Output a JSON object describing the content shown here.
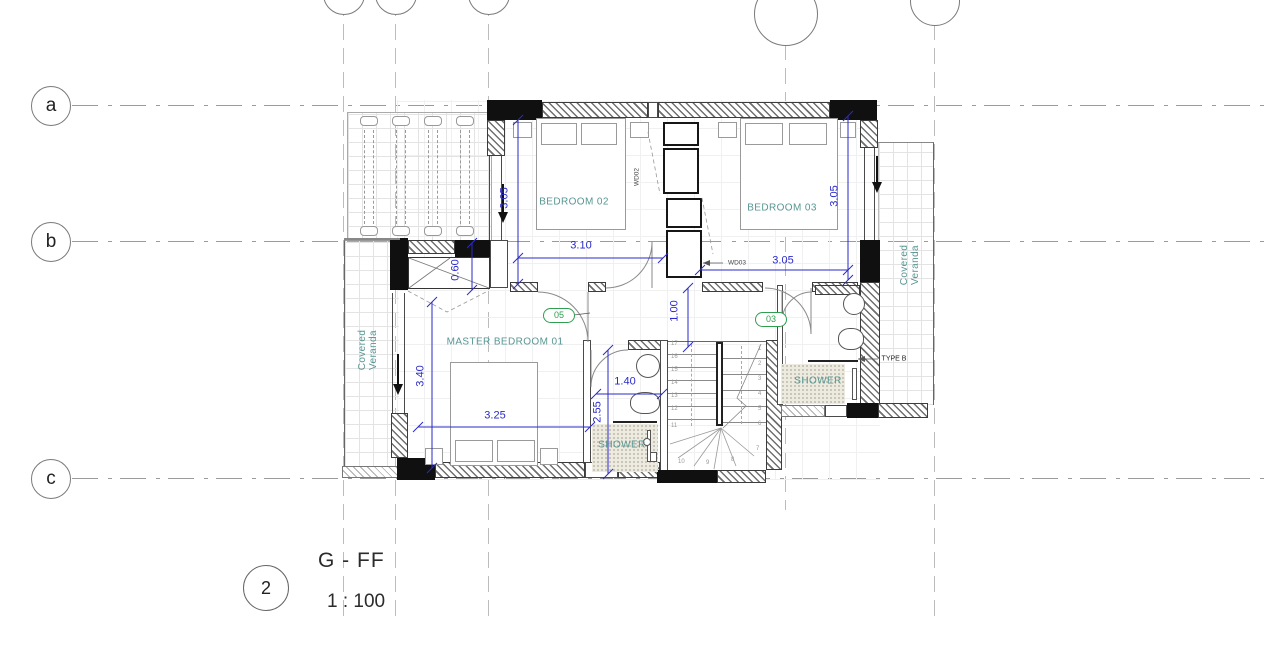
{
  "title_block": {
    "detail_number": "2",
    "view_name": "G - FF",
    "view_scale": "1 : 100"
  },
  "grid": {
    "rows": [
      "a",
      "b",
      "c"
    ]
  },
  "rooms": {
    "bedroom02": "BEDROOM 02",
    "bedroom03": "BEDROOM 03",
    "master_bedroom": "MASTER BEDROOM  01",
    "ensuite_shower": "SHOWER",
    "shower2": "SHOWER",
    "veranda_line1": "Covered",
    "veranda_line2": "Veranda"
  },
  "dimensions": {
    "bedroom02_depth": "3.05",
    "bedroom02_width": "3.10",
    "bedroom03_depth": "3.05",
    "bedroom03_width": "3.05",
    "entry_closet": "0.60",
    "corridor": "1.00",
    "master_depth": "3.40",
    "master_width": "3.25",
    "ensuite_width": "1.40",
    "ensuite_depth": "2.55"
  },
  "door_tags": {
    "master": "05",
    "bedroom03": "03"
  },
  "annotations": {
    "wardrobe02": "WD02",
    "wardrobe03": "WD03",
    "window_type": "TYPE B"
  },
  "stairs": {
    "left_run": [
      "17",
      "16",
      "15",
      "14",
      "13",
      "12",
      "11"
    ],
    "right_run": [
      "1",
      "2",
      "3",
      "4",
      "5",
      "6",
      "7"
    ],
    "winders": [
      "10",
      "9",
      "8"
    ]
  },
  "colors": {
    "dimension_blue": "#2a2ac9",
    "label_teal": "#579693",
    "tag_green": "#2f9e4f",
    "wall_black": "#111111"
  }
}
